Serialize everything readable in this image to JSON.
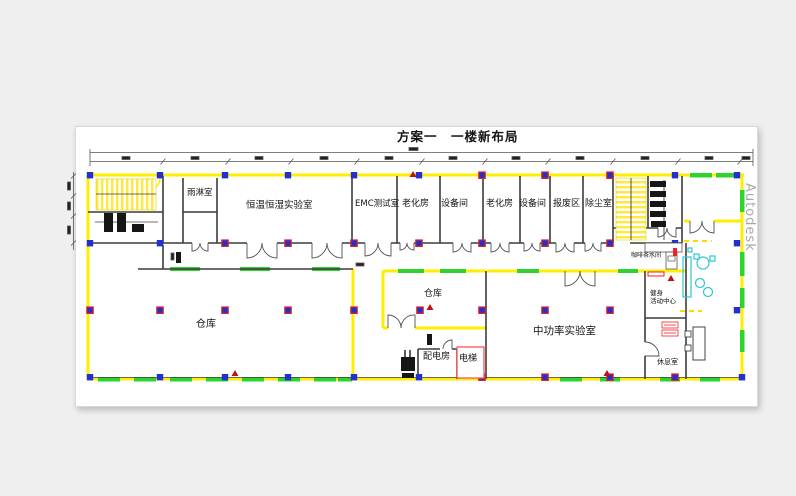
{
  "drawing": {
    "title": "方案一　一楼新布局",
    "watermark": "Autodesk",
    "rooms": {
      "rain_shower": "雨淋室",
      "const_temp_humidity_lab": "恒温恒湿实验室",
      "emc_test_room": "EMC测试室",
      "aging_room_1": "老化房",
      "equipment_room_1": "设备间",
      "aging_room_2": "老化房",
      "equipment_room_2": "设备间",
      "scrap_area": "报废区",
      "dust_removal_room": "除尘室",
      "coffee_tea_room": "咖啡茶水间",
      "fitness_center": "健身\n活动中心",
      "rest_room": "休息室",
      "warehouse_large": "仓库",
      "warehouse_small": "仓库",
      "power_distribution_room": "配电房",
      "elevator": "电梯",
      "mid_power_lab": "中功率实验室"
    },
    "colors": {
      "wall_yellow": "#ffee00",
      "window_green": "#2fd32f",
      "column_blue": "#2230cf",
      "highlight_red": "#dd2222",
      "furniture_cyan": "#2cc7cf"
    }
  }
}
